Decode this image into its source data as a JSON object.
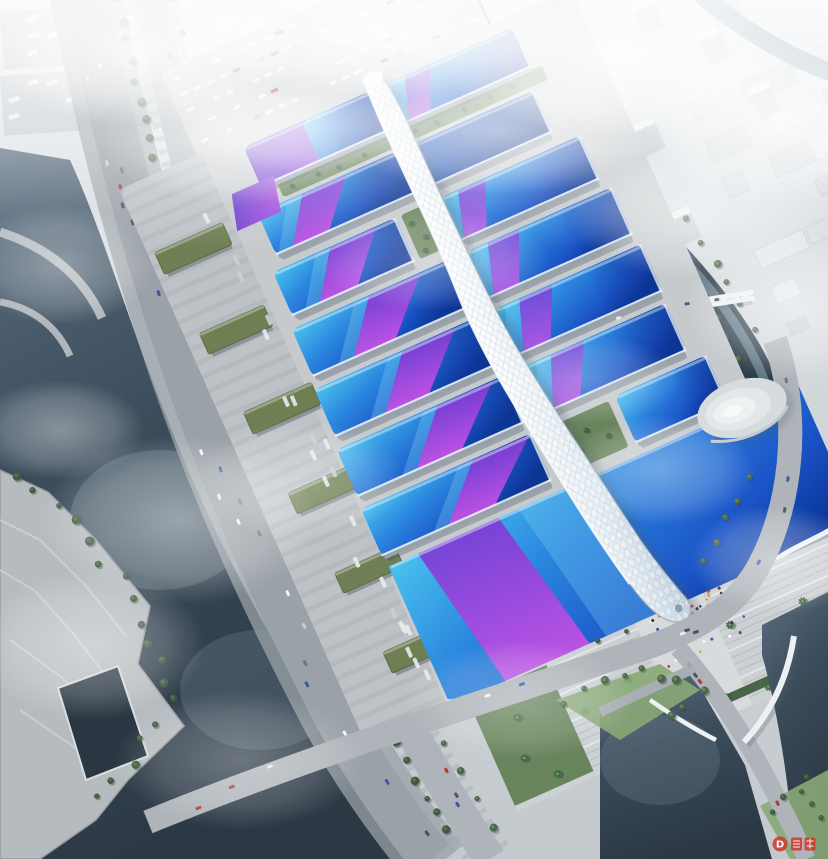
{
  "scene": {
    "name": "exhibition-center-aerial-rendering",
    "description": "Aerial bird's-eye architectural rendering of a massive exhibition and convention center: rows of blue barrel-vault exhibition halls with sweeping purple ribbon roofs flank a white serpentine central concourse that ends at a grand wavy-roofed south hall and entrance plaza, surrounded by rivers, an elevated riverside expressway, tree-lined boulevards, bus and truck parking, ponds, and a hazy city skyline fading into fog.",
    "watermark": "D"
  },
  "colors": {
    "roof_cyan": "#49c2ee",
    "roof_blue": "#2b86de",
    "roof_blue_deep": "#1b55c8",
    "roof_navy": "#0d3a9e",
    "ribbon_violet": "#7b3bd4",
    "ribbon_magenta": "#cb52e6",
    "purple_roof_a": "#5b35c8",
    "purple_roof_b": "#a44ae0",
    "spine_white": "#ffffff",
    "spine_shade": "#bfcfdc",
    "platform": "#c6cacd",
    "platform_dark": "#b7bcc0",
    "plaza": "#cdd1d4",
    "step": "#b9bec3",
    "road": "#9aa1a7",
    "road_dark": "#878d93",
    "road_light": "#aeb4b9",
    "lane_yellow": "#c9d45c",
    "bridge_white": "#edf1f3",
    "water_dark": "#2c3945",
    "water_mid": "#5b6e80",
    "water_pond": "#2a3742",
    "water_canal": "#76929f",
    "green_dark": "#49654a",
    "green": "#68845c",
    "green_light": "#8aa877",
    "green_roof": "#6d7f53",
    "city": "#d2d8dc",
    "city_light": "#e2e7ea",
    "tower": "#c2ccd3",
    "fog": "#f5f8fa",
    "crowd_red": "#c0392b",
    "watermark_red": "#d0372d"
  }
}
